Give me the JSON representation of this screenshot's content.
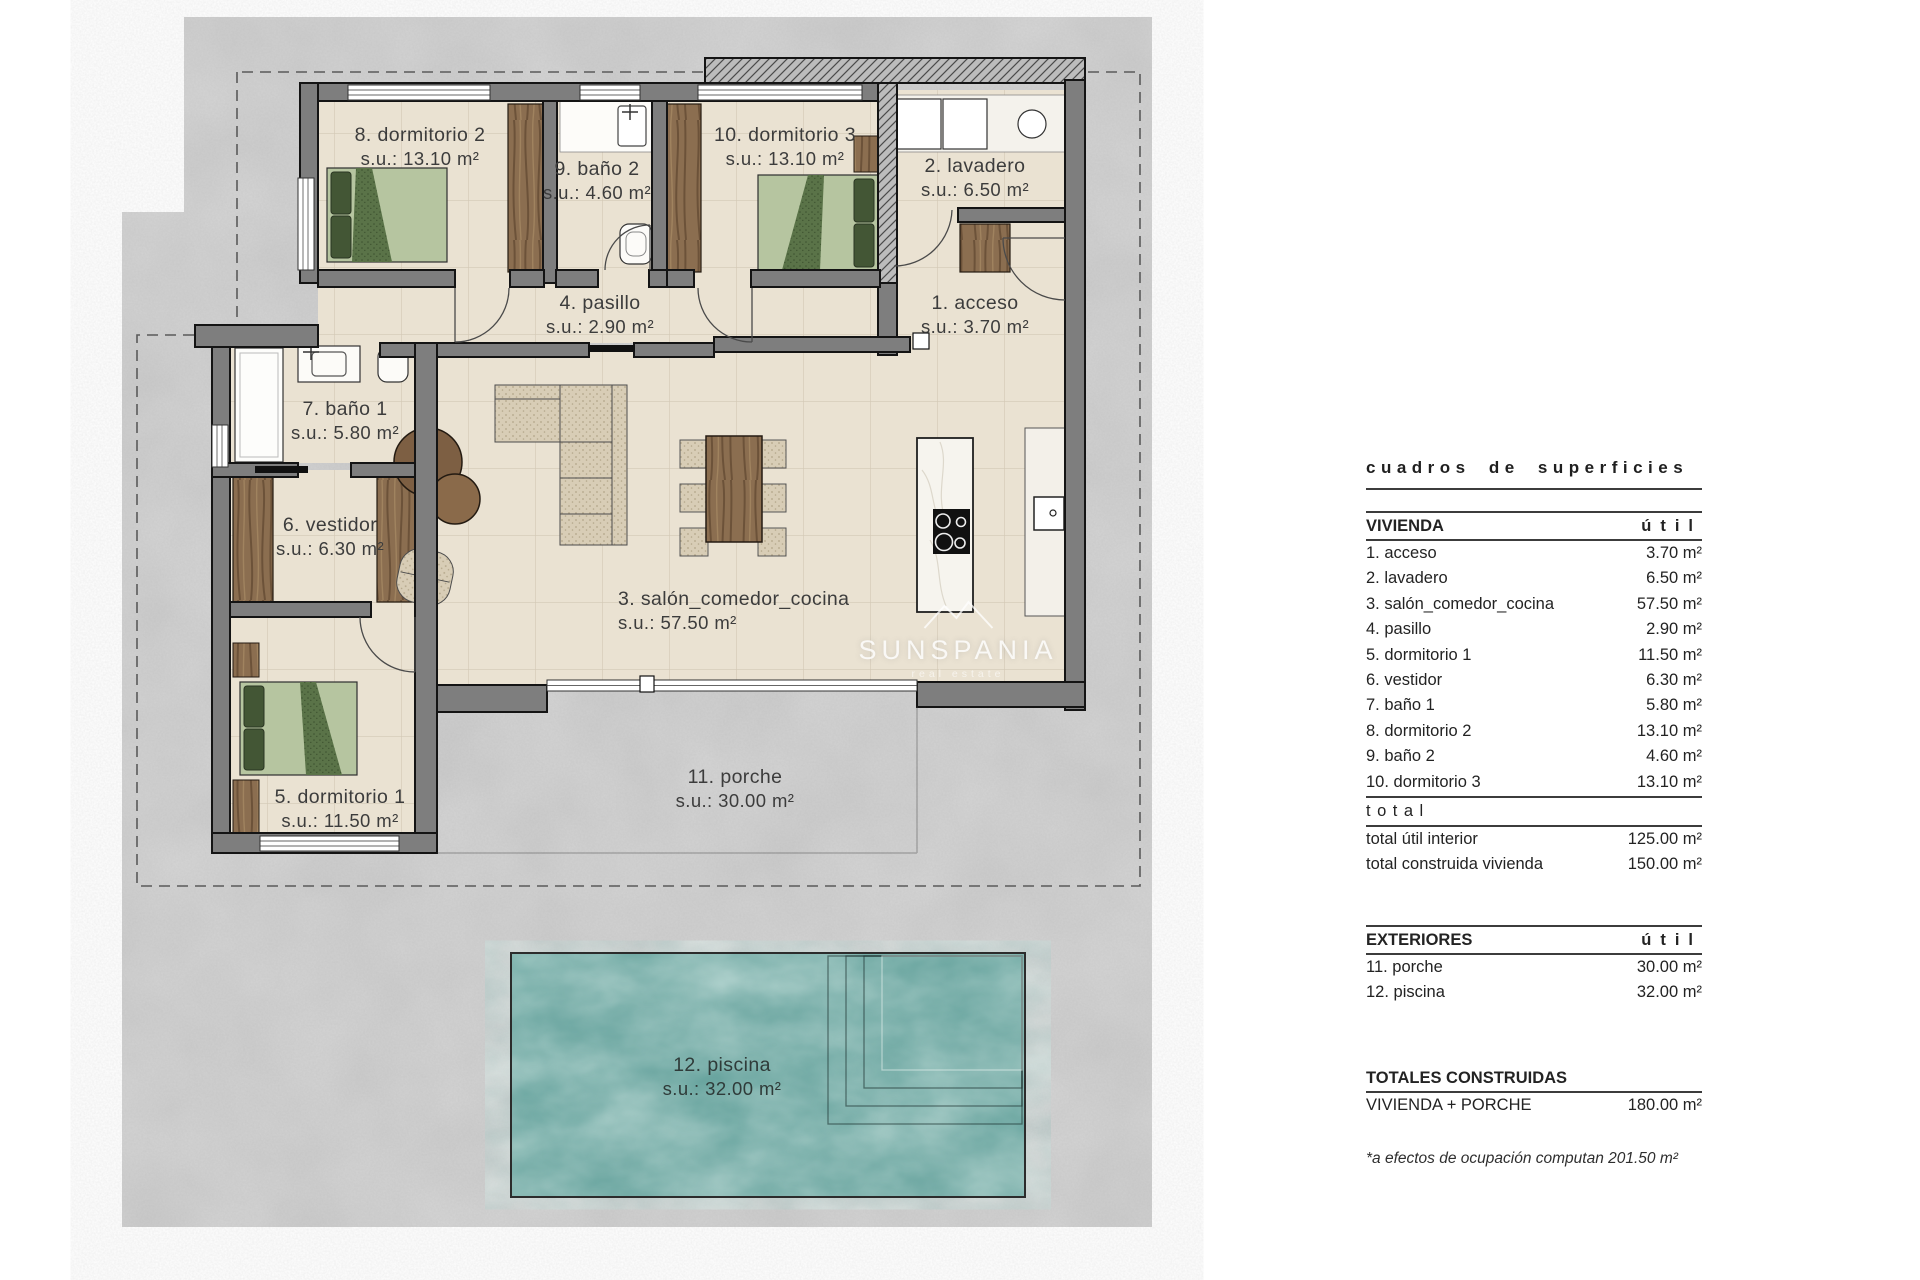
{
  "watermark": {
    "brand": "SUNSPANIA",
    "tagline": "real estate"
  },
  "plan": {
    "rooms": [
      {
        "name": "8. dormitorio 2",
        "su": "s.u.: 13.10 m²"
      },
      {
        "name": "9. baño 2",
        "su": "s.u.: 4.60 m²"
      },
      {
        "name": "10. dormitorio 3",
        "su": "s.u.: 13.10 m²"
      },
      {
        "name": "2. lavadero",
        "su": "s.u.: 6.50 m²"
      },
      {
        "name": "4. pasillo",
        "su": "s.u.: 2.90 m²"
      },
      {
        "name": "1. acceso",
        "su": "s.u.: 3.70 m²"
      },
      {
        "name": "7. baño 1",
        "su": "s.u.: 5.80 m²"
      },
      {
        "name": "6. vestidor",
        "su": "s.u.: 6.30 m²"
      },
      {
        "name": "3. salón_comedor_cocina",
        "su": "s.u.: 57.50 m²"
      },
      {
        "name": "5. dormitorio 1",
        "su": "s.u.: 11.50 m²"
      },
      {
        "name": "11. porche",
        "su": "s.u.: 30.00 m²"
      },
      {
        "name": "12. piscina",
        "su": "s.u.: 32.00 m²"
      }
    ]
  },
  "panel": {
    "title": "cuadros de superficies",
    "vivienda": {
      "header": "VIVIENDA",
      "header_col": "útil",
      "rows": [
        {
          "label": "1. acceso",
          "value": "3.70 m²"
        },
        {
          "label": "2. lavadero",
          "value": "6.50 m²"
        },
        {
          "label": "3. salón_comedor_cocina",
          "value": "57.50 m²"
        },
        {
          "label": "4. pasillo",
          "value": "2.90 m²"
        },
        {
          "label": "5. dormitorio 1",
          "value": "11.50 m²"
        },
        {
          "label": "6. vestidor",
          "value": "6.30 m²"
        },
        {
          "label": "7. baño 1",
          "value": "5.80 m²"
        },
        {
          "label": "8. dormitorio 2",
          "value": "13.10 m²"
        },
        {
          "label": "9. baño 2",
          "value": "4.60 m²"
        },
        {
          "label": "10. dormitorio 3",
          "value": "13.10 m²"
        }
      ],
      "total_label": "total",
      "totals": [
        {
          "label": "total útil interior",
          "value": "125.00 m²"
        },
        {
          "label": "total construida vivienda",
          "value": "150.00 m²"
        }
      ]
    },
    "exteriores": {
      "header": "EXTERIORES",
      "header_col": "útil",
      "rows": [
        {
          "label": "11. porche",
          "value": "30.00 m²"
        },
        {
          "label": "12. piscina",
          "value": "32.00 m²"
        }
      ]
    },
    "totales": {
      "header": "TOTALES CONSTRUIDAS",
      "rows": [
        {
          "label": "VIVIENDA + PORCHE",
          "value": "180.00 m²"
        }
      ],
      "note": "*a efectos de ocupación computan 201.50 m²"
    }
  }
}
